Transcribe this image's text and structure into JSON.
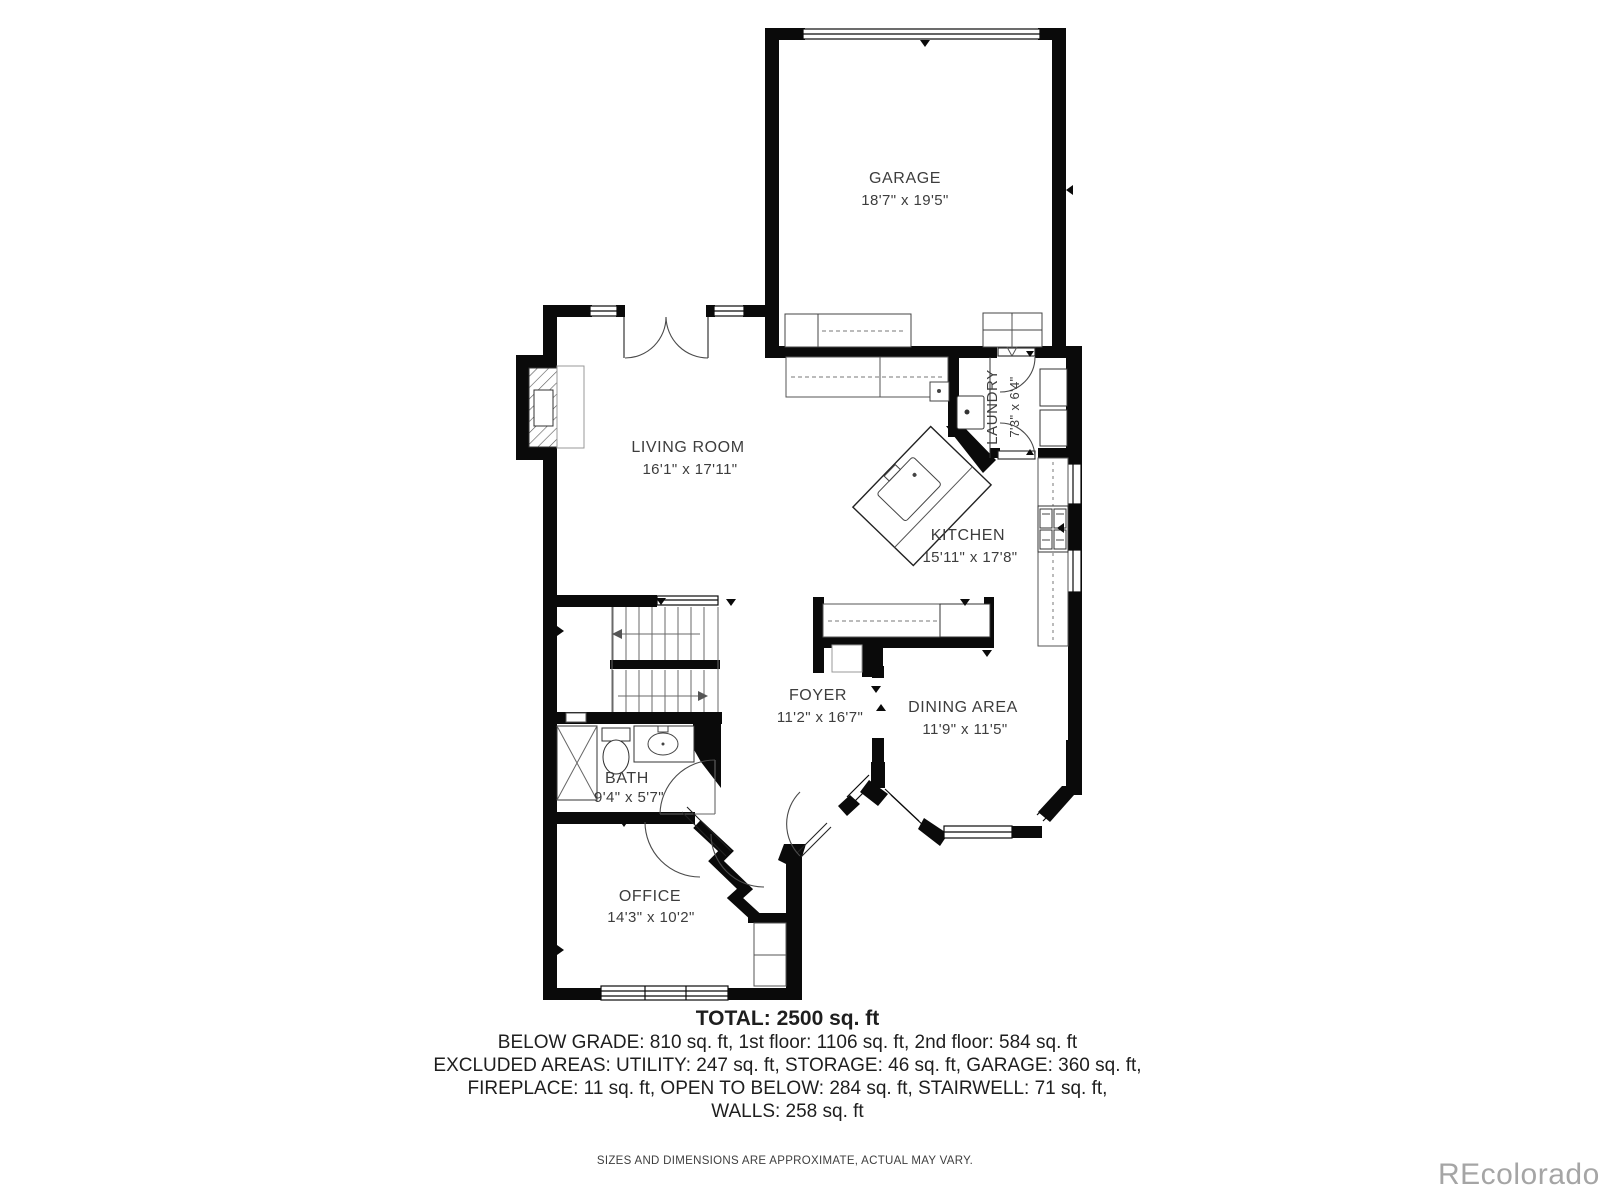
{
  "rooms": [
    {
      "name": "GARAGE",
      "dims": "18'7\" x 19'5\""
    },
    {
      "name": "LIVING ROOM",
      "dims": "16'1\" x 17'11\""
    },
    {
      "name": "LAUNDRY",
      "dims": "7'3\" x 6'4\""
    },
    {
      "name": "KITCHEN",
      "dims": "15'11\" x 17'8\""
    },
    {
      "name": "FOYER",
      "dims": "11'2\" x 16'7\""
    },
    {
      "name": "DINING AREA",
      "dims": "11'9\" x 11'5\""
    },
    {
      "name": "BATH",
      "dims": "9'4\" x 5'7\""
    },
    {
      "name": "OFFICE",
      "dims": "14'3\" x 10'2\""
    }
  ],
  "summary": {
    "total": "TOTAL: 2500 sq. ft",
    "line1": "BELOW GRADE: 810 sq. ft, 1st floor: 1106 sq. ft, 2nd floor: 584 sq. ft",
    "line2": "EXCLUDED AREAS: UTILITY: 247 sq. ft, STORAGE: 46 sq. ft, GARAGE: 360 sq. ft,",
    "line3": "FIREPLACE: 11 sq. ft, OPEN TO BELOW: 284 sq. ft, STAIRWELL: 71 sq. ft,",
    "line4": "WALLS: 258 sq. ft"
  },
  "disclaimer": "SIZES AND DIMENSIONS ARE APPROXIMATE, ACTUAL MAY VARY.",
  "watermark": "REcolorado",
  "colors": {
    "wall": "#0a0a0a",
    "label_text": "#3d3d3d",
    "summary_text": "#1e1e1e",
    "watermark": "#a5a5a5"
  }
}
